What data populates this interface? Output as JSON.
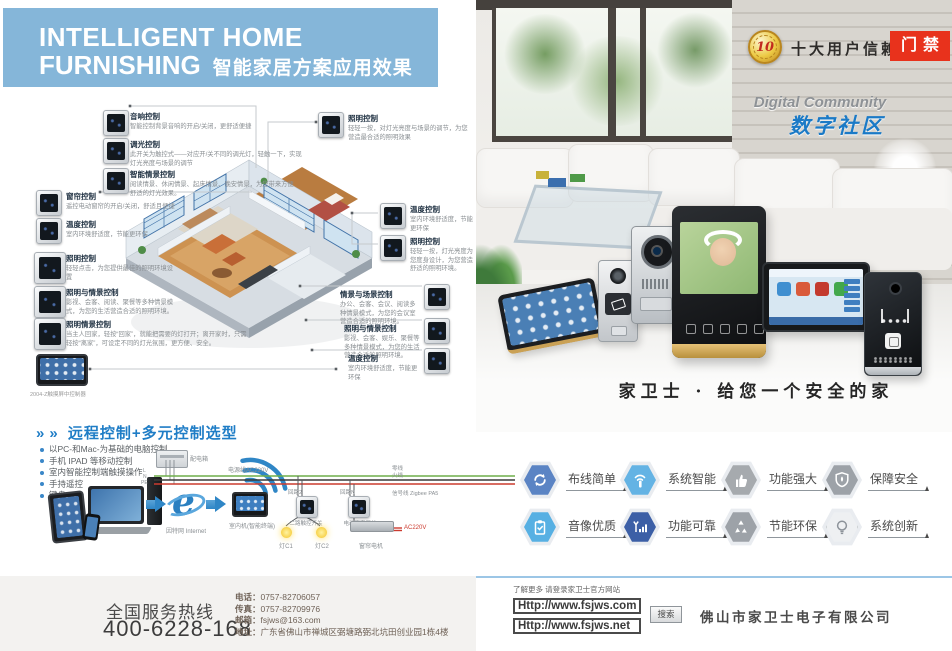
{
  "colors": {
    "header_blue": "#85b6d9",
    "brand_blue": "#1f7dc6",
    "tag_red": "#e8321c",
    "footer_line_blue": "#9cc6e6",
    "feature_hex": [
      "#5b84c4",
      "#64b3e4",
      "#a6aaae",
      "#9da2a8",
      "#57b0e3",
      "#3c5fa6",
      "#9da2a8",
      "#eef0f2"
    ]
  },
  "header": {
    "title1": "INTELLIGENT HOME",
    "title2": "FURNISHING",
    "subtitle": "智能家居方案应用效果"
  },
  "badge": {
    "number": "10",
    "text": "十大用户信赖品牌",
    "tag": "门禁"
  },
  "community": {
    "en": "Digital Community",
    "zh": "数字社区"
  },
  "slogan": "家卫士 · 给您一个安全的家",
  "left": {
    "annotations": [
      {
        "title": "音响控制",
        "desc": "智能控制背景音响的开启/关闭，更舒适便捷"
      },
      {
        "title": "调光控制",
        "desc": "此开关为触控式——对应开/关不同的调光灯，轻触一下，实现灯光亮度与场景的调节"
      },
      {
        "title": "智能情景控制",
        "desc": "阅读情景、休闲情景、起床情景、晚安情景，为您带来方便舒适的灯光效果。"
      },
      {
        "title": "窗帘控制",
        "desc": "遥控电动窗帘的开启/关闭，舒适且便捷"
      },
      {
        "title": "温度控制",
        "desc": "室内环境舒适度，节能更环保"
      },
      {
        "title": "照明控制",
        "desc": "轻轻点击，为您提供最佳的照明环境设置"
      },
      {
        "title": "照明与情景控制",
        "desc": "影视、会客、阅读、聚餐等多种情景模式，为您的生活营造合适的照明环境。"
      },
      {
        "title": "照明情景控制",
        "desc": "当主人回家，轻按“回家”，就能把需要的灯打开；离开家时，只需轻按“离家”，可设定不同的灯光氛围，更方便、安全。"
      },
      {
        "title": "照明控制",
        "desc": "轻轻一按，对灯光亮度与场景的调节，为您营造最合适的照明效果"
      },
      {
        "title": "温度控制",
        "desc": "室内环境舒适度，节能更环保"
      },
      {
        "title": "照明控制",
        "desc": "轻轻一按，灯光亮度为您度身设计，为您营造舒适的照明环境。"
      },
      {
        "title": "情景与场景控制",
        "desc": "办公、会客、会议、阅读多种情景模式，为您的会议室营造合适的照明环境。"
      },
      {
        "title": "照明与情景控制",
        "desc": "影视、会客、娱乐、聚餐等多种情景模式，为您的生活营造合适的照明环境。"
      },
      {
        "title": "温度控制",
        "desc": "室内环境舒适度，节能更环保"
      }
    ],
    "tablet_caption": "2004-Z触摸屏中控制器",
    "remote": {
      "arrows": "»",
      "title": "远程控制+多元控制选型",
      "bullets": [
        "以PC-和Mac-为基础的电脑控制",
        "手机 IPAD 等移动控制",
        "室内智能控制端触摸操作",
        "手持遥控",
        "键盘"
      ],
      "diagram": {
        "power_box": "配电箱",
        "power_line": "电源线AC220V",
        "phase_l": "L",
        "phase_n": "N",
        "phase_pe": "PE",
        "loop2": "回路2",
        "loopN": "回路N",
        "wire_end_1": "零线",
        "wire_end_2": "火线",
        "wire_end_3": "信号线 Zigbee PA5",
        "internet": "因特网 Internet",
        "indoor_unit": "室内机(智能终端)",
        "switch1": "二路触控开关",
        "switch2": "电动窗帘开关",
        "lamp1": "灯C1",
        "lamp2": "灯C2",
        "motor": "窗帘电机",
        "ac": "AC220V"
      }
    },
    "hotline": {
      "label": "全国服务热线",
      "number": "400-6228-168",
      "contacts": [
        {
          "k": "电话：",
          "v": "0757-82706057"
        },
        {
          "k": "传真：",
          "v": "0757-82709976"
        },
        {
          "k": "邮箱：",
          "v": "fsjws@163.com"
        },
        {
          "k": "地址：",
          "v": "广东省佛山市禅城区弼塘路弼北坑田创业园1栋4楼"
        }
      ]
    }
  },
  "right": {
    "features": [
      {
        "label": "布线简单",
        "icon": "circular-arrows-icon",
        "hex_style": "background:#5b84c4"
      },
      {
        "label": "系统智能",
        "icon": "smart-touch-icon",
        "hex_style": "background:#64b3e4"
      },
      {
        "label": "功能强大",
        "icon": "thumbs-up-icon",
        "hex_style": "background:#a6aaae"
      },
      {
        "label": "保障安全",
        "icon": "shield-icon",
        "hex_style": "background:#9da2a8"
      },
      {
        "label": "音像优质",
        "icon": "clipboard-icon",
        "hex_style": "background:#57b0e3"
      },
      {
        "label": "功能可靠",
        "icon": "signal-icon",
        "hex_style": "background:#3c5fa6"
      },
      {
        "label": "节能环保",
        "icon": "recycle-icon",
        "hex_style": "background:#9da2a8"
      },
      {
        "label": "系统创新",
        "icon": "bulb-icon",
        "hex_style": "background:#eef0f2;border:1px solid #c6cacd"
      }
    ],
    "footer": {
      "hint": "了解更多 请登录家卫士官方网站",
      "url1": "Http://www.fsjws.com",
      "url2": "Http://www.fsjws.net",
      "search": "搜索",
      "company": "佛山市家卫士电子有限公司"
    }
  }
}
